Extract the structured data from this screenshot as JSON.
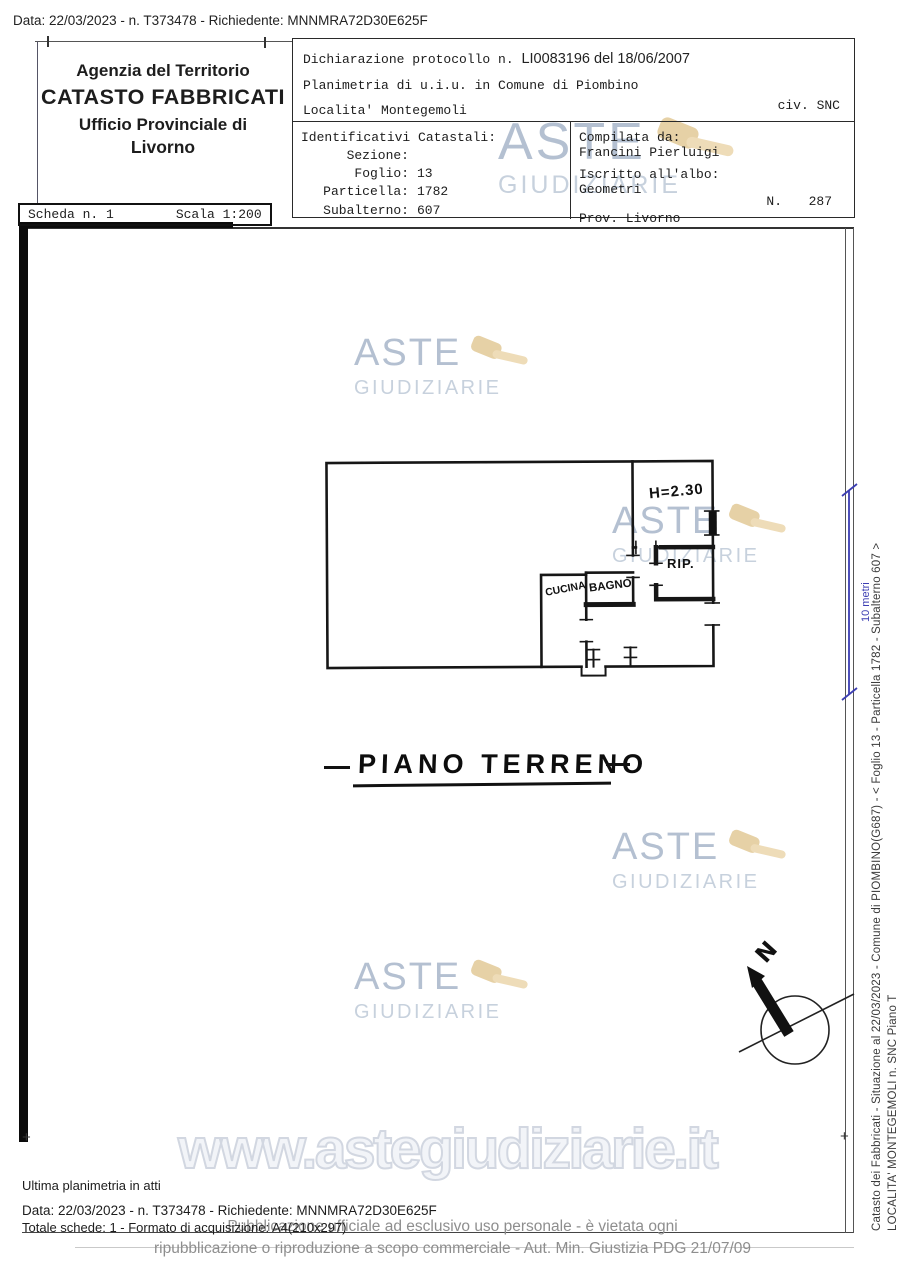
{
  "top_bar": {
    "text": "Data: 22/03/2023 - n. T373478 - Richiedente: MNNMRA72D30E625F"
  },
  "header": {
    "agency": {
      "line1": "Agenzia del Territorio",
      "line2": "CATASTO FABBRICATI",
      "line3": "Ufficio Provinciale di",
      "line4": "Livorno"
    },
    "scheda": {
      "label": "Scheda n. 1",
      "scala": "Scala 1:200"
    },
    "declaration": {
      "protocol_label": "Dichiarazione protocollo n.",
      "protocol_value": "LI0083196 del 18/06/2007",
      "line2": "Planimetria di u.i.u. in Comune di Piombino",
      "line3": "Localita' Montegemoli",
      "civ": "civ. SNC"
    },
    "identificativi": {
      "title": "Identificativi Catastali:",
      "rows": [
        {
          "label": "Sezione:",
          "value": ""
        },
        {
          "label": "Foglio:",
          "value": "13"
        },
        {
          "label": "Particella:",
          "value": "1782"
        },
        {
          "label": "Subalterno:",
          "value": "607"
        }
      ]
    },
    "compilata": {
      "label": "Compilata da:",
      "name": "Francini Pierluigi",
      "albo_label": "Iscritto all'albo:",
      "albo_value": "Geometri",
      "prov": "Prov. Livorno",
      "n_label": "N.",
      "n_value": "287"
    }
  },
  "plan": {
    "floor_label": "PIANO TERRENO",
    "rooms": {
      "cucina": "CUCINA",
      "bagno": "BAGNO",
      "rip": "RIP.",
      "height": "H=2.30"
    },
    "north_label": "N",
    "scale_label": "10 metri"
  },
  "watermark": {
    "aste": "ASTE",
    "giudiziarie": "GIUDIZIARIE",
    "url": "www.astegiudiziarie.it"
  },
  "margin_vertical": {
    "line1": "Catasto dei Fabbricati - Situazione al 22/03/2023 - Comune di PIOMBINO(G687) - < Foglio 13 - Particella 1782 - Subalterno 607 >",
    "line2": "LOCALITA' MONTEGEMOLI n. SNC Piano T"
  },
  "footer": {
    "ultima": "Ultima planimetria in atti",
    "data_line": "Data: 22/03/2023 - n. T373478 - Richiedente: MNNMRA72D30E625F",
    "totale": "Totale schede: 1 - Formato di acquisizione: A4(210x297)",
    "gray1": "Pubblicazione ufficiale ad esclusivo uso personale - è vietata ogni",
    "gray2": "ripubblicazione o riproduzione a scopo commerciale - Aut. Min. Giustizia PDG 21/07/09"
  }
}
